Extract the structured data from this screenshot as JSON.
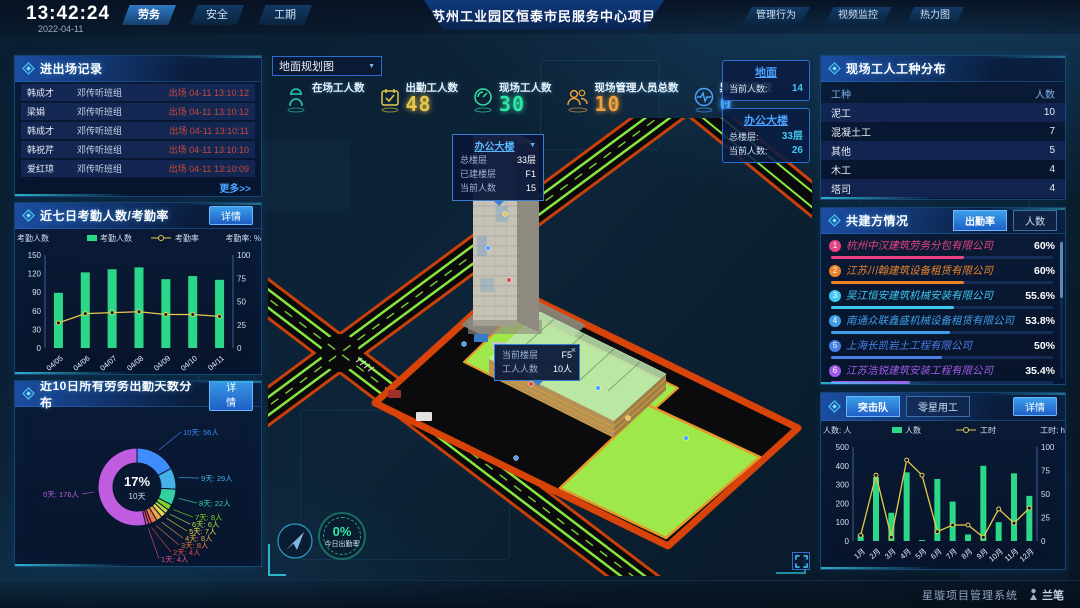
{
  "topbar": {
    "time": "13:42:24",
    "date": "2022-04-11",
    "nav_left": [
      "劳务",
      "安全",
      "工期"
    ],
    "nav_left_active": "劳务",
    "title": "苏州工业园区恒泰市民服务中心项目",
    "nav_right": [
      "管理行为",
      "视频监控",
      "热力图"
    ]
  },
  "colors": {
    "accent_cyan": "#35d8f0",
    "accent_blue": "#2f7fd6",
    "bar_green": "#2bd889",
    "line_yellow": "#e8c94a",
    "alert_red": "#c8483a"
  },
  "left": {
    "entry_exit": {
      "title": "进出场记录",
      "more_label": "更多>>",
      "rows": [
        {
          "name": "韩成才",
          "team": "邓传听班组",
          "event": "出场 04-11 13:10:12"
        },
        {
          "name": "梁娟",
          "team": "邓传听班组",
          "event": "出场 04-11 13:10:12"
        },
        {
          "name": "韩成才",
          "team": "邓传听班组",
          "event": "出场 04-11 13:10:11"
        },
        {
          "name": "韩祝芹",
          "team": "邓传听班组",
          "event": "出场 04-11 13:10:10"
        },
        {
          "name": "爱红琼",
          "team": "邓传听班组",
          "event": "出场 04-11 13:10:09"
        }
      ]
    },
    "attendance": {
      "title": "近七日考勤人数/考勤率",
      "detail_label": "详情"
    },
    "distribution": {
      "title": "近10日所有劳务出勤天数分布",
      "detail_label": "详情"
    }
  },
  "map": {
    "view_select": "地面规划图",
    "stats": [
      {
        "label": "在场工人数",
        "value": "",
        "icon": "worker-icon",
        "color": "#2ad0c0"
      },
      {
        "label": "出勤工人数",
        "value": "48",
        "icon": "calendar-check-icon",
        "color": "#e8c84a"
      },
      {
        "label": "现场工人数",
        "value": "30",
        "icon": "gauge-icon",
        "color": "#2ee6a6"
      },
      {
        "label": "现场管理人员总数",
        "value": "10",
        "icon": "people-icon",
        "color": "#f0a03c"
      },
      {
        "label": "异常出勤数",
        "value": "0",
        "icon": "pulse-icon",
        "color": "#4aa3ff"
      }
    ],
    "overlays": [
      {
        "title": "地面",
        "rows": [
          {
            "label": "当前人数:",
            "value": "14"
          }
        ]
      },
      {
        "title": "办公大楼",
        "rows": [
          {
            "label": "总楼层:",
            "value": "33层"
          },
          {
            "label": "当前人数:",
            "value": "26"
          }
        ]
      }
    ],
    "building_tooltip": {
      "title": "办公大楼",
      "rows": [
        {
          "label": "总楼层",
          "value": "33层"
        },
        {
          "label": "已建楼层",
          "value": "F1"
        },
        {
          "label": "当前人数",
          "value": "15"
        }
      ]
    },
    "floor_tooltip": {
      "close": "×",
      "rows": [
        {
          "label": "当前楼层",
          "value": "F5"
        },
        {
          "label": "工人人数",
          "value": "10人"
        }
      ]
    },
    "gauge": {
      "value": "0%",
      "label": "今日出勤率"
    }
  },
  "right": {
    "trades": {
      "title": "现场工人工种分布",
      "headers": [
        "工种",
        "人数"
      ],
      "rows": [
        [
          "泥工",
          "10"
        ],
        [
          "混凝土工",
          "7"
        ],
        [
          "其他",
          "5"
        ],
        [
          "木工",
          "4"
        ],
        [
          "塔司",
          "4"
        ]
      ]
    },
    "partners": {
      "title": "共建方情况",
      "tabs": [
        "出勤率",
        "人数"
      ],
      "active_tab": "出勤率",
      "items": [
        {
          "rank": "1",
          "name": "杭州中汉建筑劳务分包有限公司",
          "value": "60%",
          "percent": 60,
          "color": "#e8447f"
        },
        {
          "rank": "2",
          "name": "江苏川翰建筑设备租赁有限公司",
          "value": "60%",
          "percent": 60,
          "color": "#e8832a"
        },
        {
          "rank": "3",
          "name": "吴江恒安建筑机械安装有限公司",
          "value": "55.6%",
          "percent": 55.6,
          "color": "#3fc8f0"
        },
        {
          "rank": "4",
          "name": "南通众联鑫盛机械设备租赁有限公司",
          "value": "53.8%",
          "percent": 53.8,
          "color": "#3f9fe8"
        },
        {
          "rank": "5",
          "name": "上海长凯岩土工程有限公司",
          "value": "50%",
          "percent": 50,
          "color": "#4a7fe8"
        },
        {
          "rank": "6",
          "name": "江苏浩锐建筑安装工程有限公司",
          "value": "35.4%",
          "percent": 35.4,
          "color": "#9f5ae8"
        }
      ]
    },
    "squad": {
      "tabs": [
        "突击队",
        "零星用工"
      ],
      "active_tab": "突击队",
      "detail_label": "详情"
    }
  },
  "footer": {
    "system_name": "星璇项目管理系统",
    "logo_text": "兰笔"
  },
  "chart_data": [
    {
      "id": "attendance",
      "type": "bar+line",
      "categories": [
        "04/05",
        "04/06",
        "04/07",
        "04/08",
        "04/09",
        "04/10",
        "04/11"
      ],
      "series": [
        {
          "name": "考勤人数",
          "type": "bar",
          "color": "#2bd889",
          "values": [
            89,
            122,
            127,
            130,
            111,
            116,
            110
          ]
        },
        {
          "name": "考勤率",
          "type": "line",
          "color": "#e8c94a",
          "axis": "right",
          "values": [
            27,
            37,
            38,
            39,
            36,
            36,
            34
          ]
        }
      ],
      "ylabel_left": "考勤人数",
      "ylabel_right": "考勤率: %",
      "ylim_left": [
        0,
        150
      ],
      "ylim_right": [
        0,
        100
      ],
      "yticks_left": [
        0,
        30,
        60,
        90,
        120,
        150
      ],
      "yticks_right": [
        0,
        25,
        50,
        75,
        100
      ],
      "legend_position": "top",
      "grid": false
    },
    {
      "id": "distribution",
      "type": "pie",
      "slices": [
        {
          "label": "10天",
          "value": 56,
          "text": "10天: 56人",
          "color": "#3f8cff"
        },
        {
          "label": "9天",
          "value": 29,
          "text": "9天: 29人",
          "color": "#45b1e8"
        },
        {
          "label": "8天",
          "value": 22,
          "text": "8天: 22人",
          "color": "#35d0a0"
        },
        {
          "label": "7天",
          "value": 8,
          "text": "7天: 8人",
          "color": "#7ed321"
        },
        {
          "label": "6天",
          "value": 6,
          "text": "6天: 6人",
          "color": "#b8d848"
        },
        {
          "label": "5天",
          "value": 7,
          "text": "5天: 7人",
          "color": "#e8d84a"
        },
        {
          "label": "4天",
          "value": 8,
          "text": "4天: 8人",
          "color": "#e8a84a"
        },
        {
          "label": "3天",
          "value": 8,
          "text": "3天: 8人",
          "color": "#e8784a"
        },
        {
          "label": "2天",
          "value": 4,
          "text": "2天: 4人",
          "color": "#e84a4a"
        },
        {
          "label": "1天",
          "value": 4,
          "text": "1天: 4人",
          "color": "#e84a8a"
        },
        {
          "label": "0天",
          "value": 176,
          "text": "0天: 176人",
          "color": "#c05ce0"
        }
      ],
      "center": {
        "percent": "17%",
        "label": "10天"
      }
    },
    {
      "id": "squad",
      "type": "bar+line",
      "categories": [
        "1月",
        "2月",
        "3月",
        "4月",
        "5月",
        "6月",
        "7月",
        "8月",
        "9月",
        "10月",
        "11月",
        "12月"
      ],
      "series": [
        {
          "name": "人数",
          "type": "bar",
          "color": "#2bd889",
          "values": [
            35,
            340,
            150,
            365,
            5,
            330,
            210,
            35,
            400,
            100,
            360,
            240
          ]
        },
        {
          "name": "工时",
          "type": "line",
          "color": "#e8c94a",
          "axis": "right",
          "values": [
            6,
            70,
            4,
            86,
            70,
            10,
            17,
            17,
            4,
            34,
            19,
            35
          ]
        }
      ],
      "ylabel_left": "人数: 人",
      "ylabel_right": "工时: h",
      "ylim_left": [
        0,
        500
      ],
      "ylim_right": [
        0,
        100
      ],
      "yticks_left": [
        0,
        100,
        200,
        300,
        400,
        500
      ],
      "yticks_right": [
        0,
        25,
        50,
        75,
        100
      ],
      "legend_position": "top",
      "grid": false
    }
  ]
}
